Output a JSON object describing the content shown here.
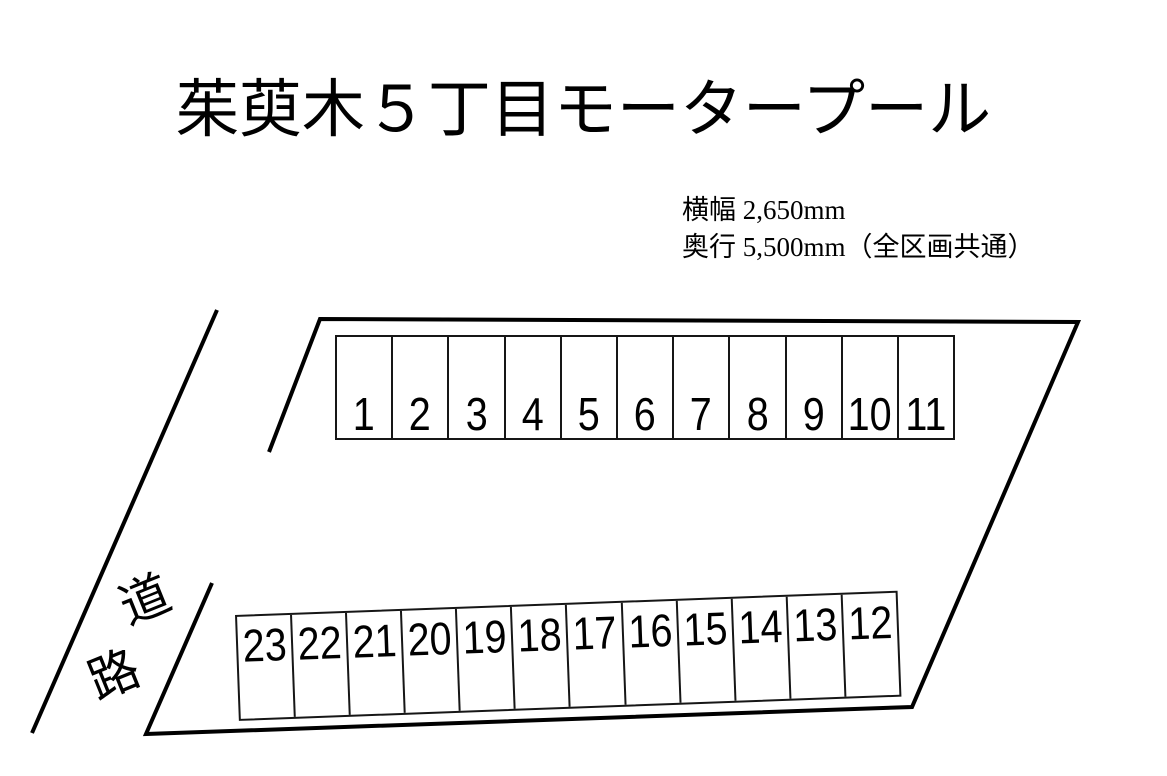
{
  "title": "茱萸木５丁目モータープール",
  "specs": {
    "width_label": "横幅 2,650mm",
    "depth_label": "奥行 5,500mm（全区画共通）"
  },
  "road": {
    "chars": [
      "道",
      "路"
    ]
  },
  "lot": {
    "top_row": {
      "spaces": [
        "1",
        "2",
        "3",
        "4",
        "5",
        "6",
        "7",
        "8",
        "9",
        "10",
        "11"
      ]
    },
    "bottom_row": {
      "spaces": [
        "23",
        "22",
        "21",
        "20",
        "19",
        "18",
        "17",
        "16",
        "15",
        "14",
        "13",
        "12"
      ]
    }
  },
  "colors": {
    "background": "#ffffff",
    "line": "#000000",
    "text": "#000000"
  }
}
